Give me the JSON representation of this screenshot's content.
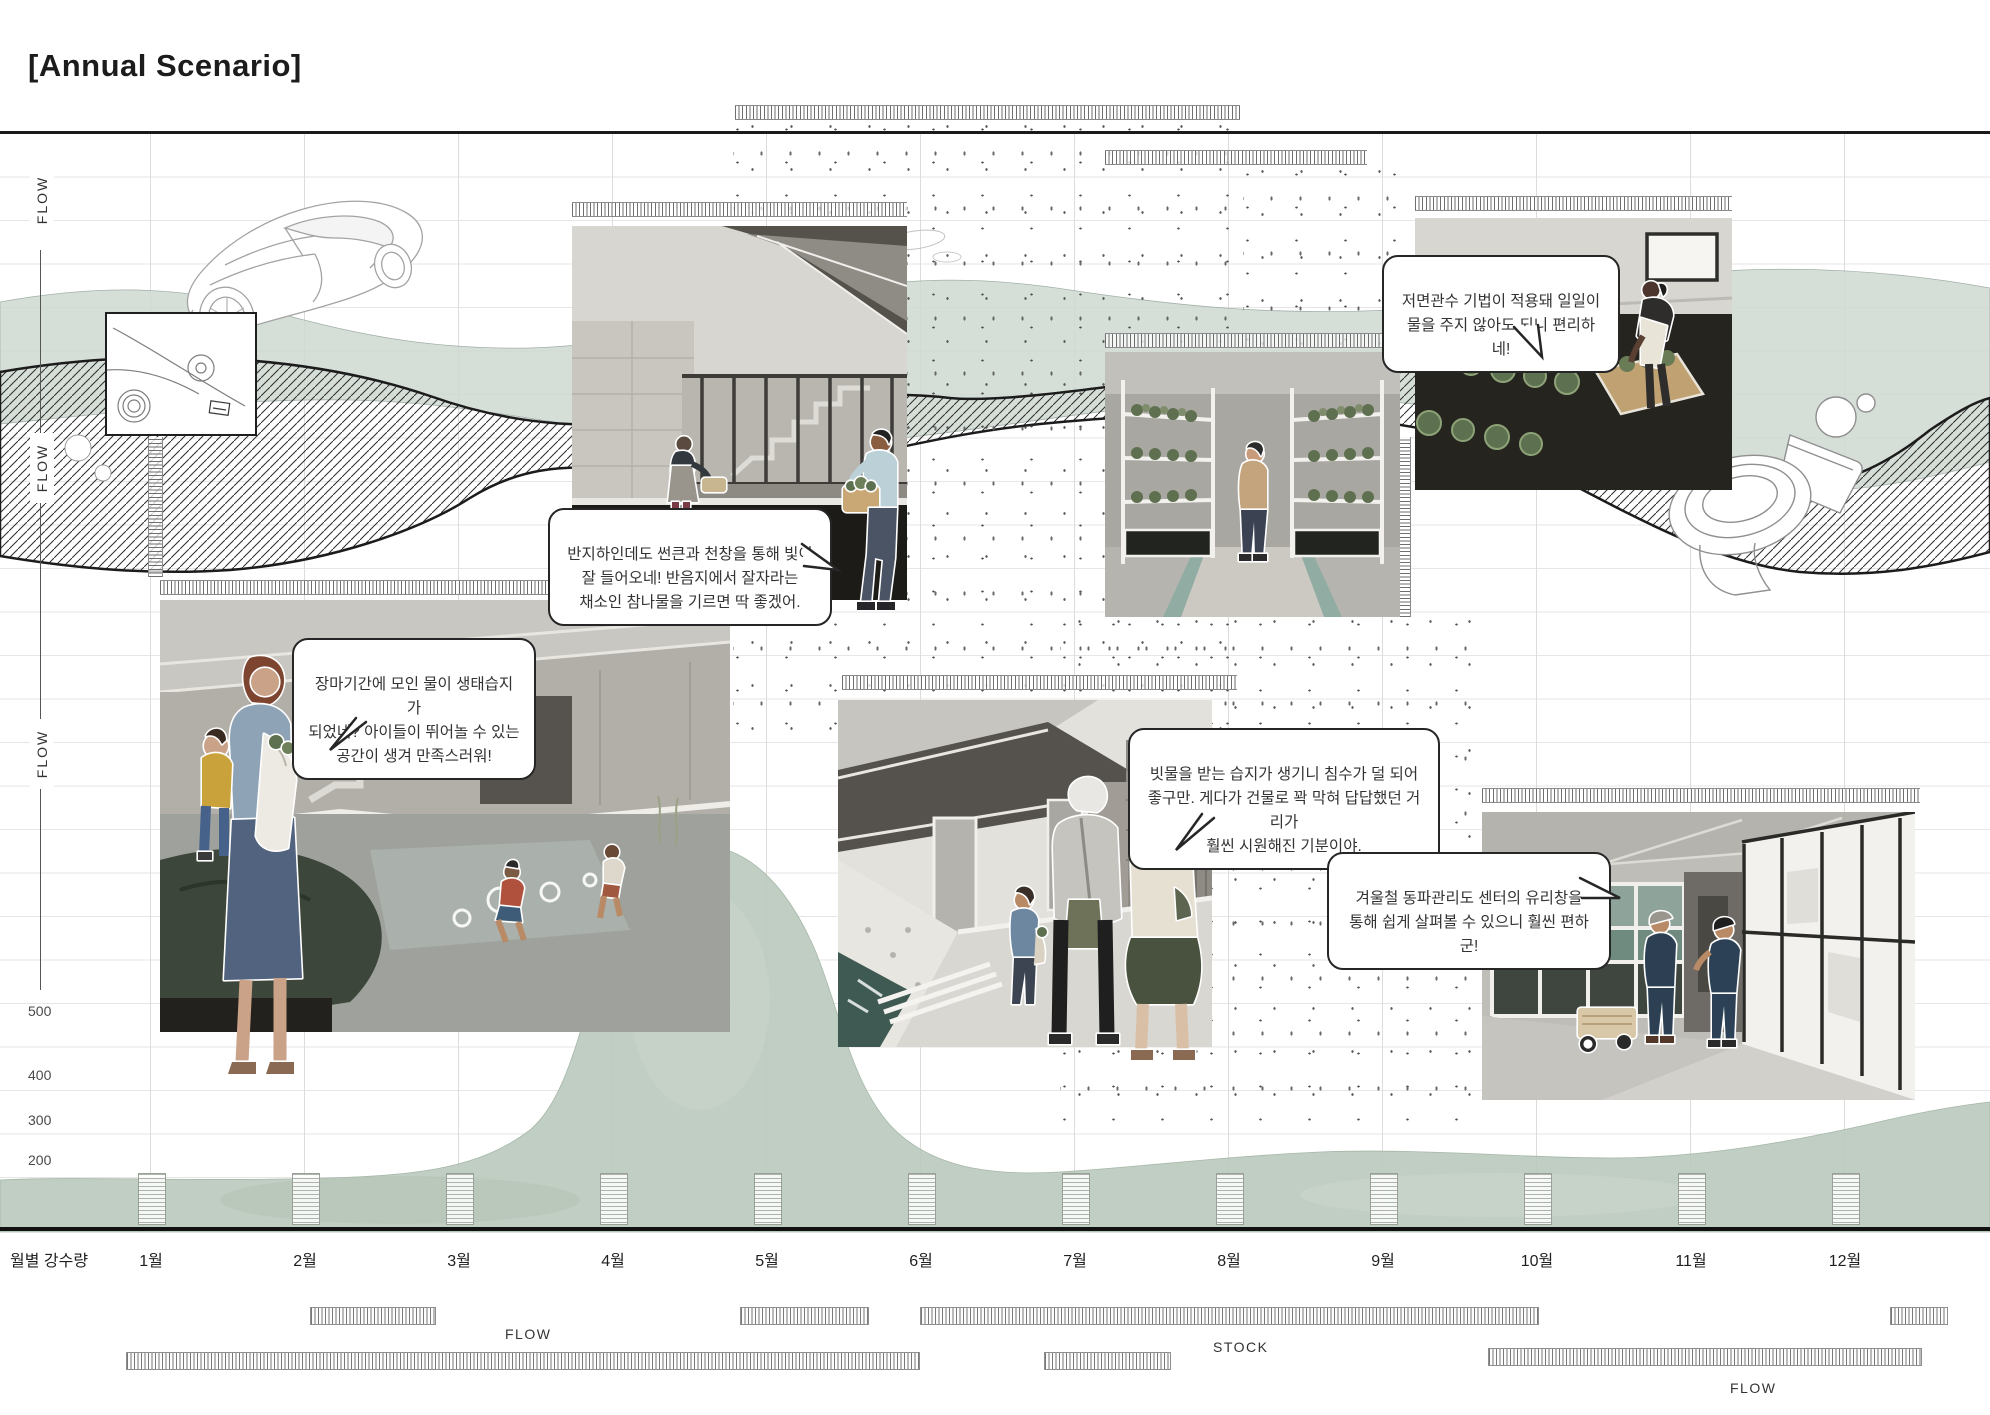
{
  "title": "[Annual Scenario]",
  "left_axis": {
    "flow_labels": [
      "FLOW",
      "FLOW",
      "FLOW"
    ],
    "tick_values": [
      "500",
      "400",
      "300",
      "200"
    ]
  },
  "bottom_axis": {
    "row_label": "월별 강수량",
    "months": [
      "1월",
      "2월",
      "3월",
      "4월",
      "5월",
      "6월",
      "7월",
      "8월",
      "9월",
      "10월",
      "11월",
      "12월"
    ]
  },
  "timeline_labels": {
    "flow_left": "FLOW",
    "stock": "STOCK",
    "flow_right": "FLOW"
  },
  "speech_bubbles": [
    {
      "id": "bottom-irrigation",
      "text": "저면관수 기법이 적용돼 일일이\n물을 주지 않아도 되니 편리하네!"
    },
    {
      "id": "sunken-light",
      "text": "반지하인데도 썬큰과 천창을 통해 빛이\n잘 들어오네! 반음지에서 잘자라는\n채소인 참나물을 기르면 딱 좋겠어."
    },
    {
      "id": "wetland-play",
      "text": "장마기간에 모인 물이 생태습지가\n되었네? 아이들이 뛰어놀 수 있는\n공간이 생겨 만족스러워!"
    },
    {
      "id": "street-swale",
      "text": "빗물을 받는 습지가 생기니 침수가 덜 되어\n좋구만. 게다가 건물로 꽉 막혀 답답했던 거리가\n훨씬 시원해진 기분이야."
    },
    {
      "id": "winter-center",
      "text": "겨울철 동파관리도 센터의 유리창을\n통해 쉽게 살펴볼 수 있으니 훨씬 편하군!"
    }
  ],
  "colors": {
    "sage_band": "#cfd9d2",
    "green_band": "#bccabe",
    "ink": "#1a1a1a",
    "grid": "#e6e6e6"
  },
  "chart_data": {
    "type": "table",
    "description": "Annual scenario timeline: monthly rainfall axis with FLOW/STOCK duration bars",
    "months": [
      "1월",
      "2월",
      "3월",
      "4월",
      "5월",
      "6월",
      "7월",
      "8월",
      "9월",
      "10월",
      "11월",
      "12월"
    ],
    "rainfall_axis_ticks": [
      200,
      300,
      400,
      500
    ],
    "bar_rows": [
      {
        "row": 1,
        "bars_month_span": [
          [
            2.0,
            2.85
          ],
          [
            4.8,
            5.65
          ],
          [
            6.0,
            10.0
          ],
          [
            12.3,
            12.65
          ]
        ]
      },
      {
        "row": 2,
        "bars_month_span": [
          [
            0.85,
            6.0
          ],
          [
            6.8,
            7.6
          ],
          [
            9.7,
            12.5
          ]
        ]
      }
    ],
    "row_annotations": [
      {
        "label": "FLOW",
        "near_month": 3.3
      },
      {
        "label": "STOCK",
        "near_month": 7.9
      },
      {
        "label": "FLOW",
        "near_month": 11.3
      }
    ]
  }
}
